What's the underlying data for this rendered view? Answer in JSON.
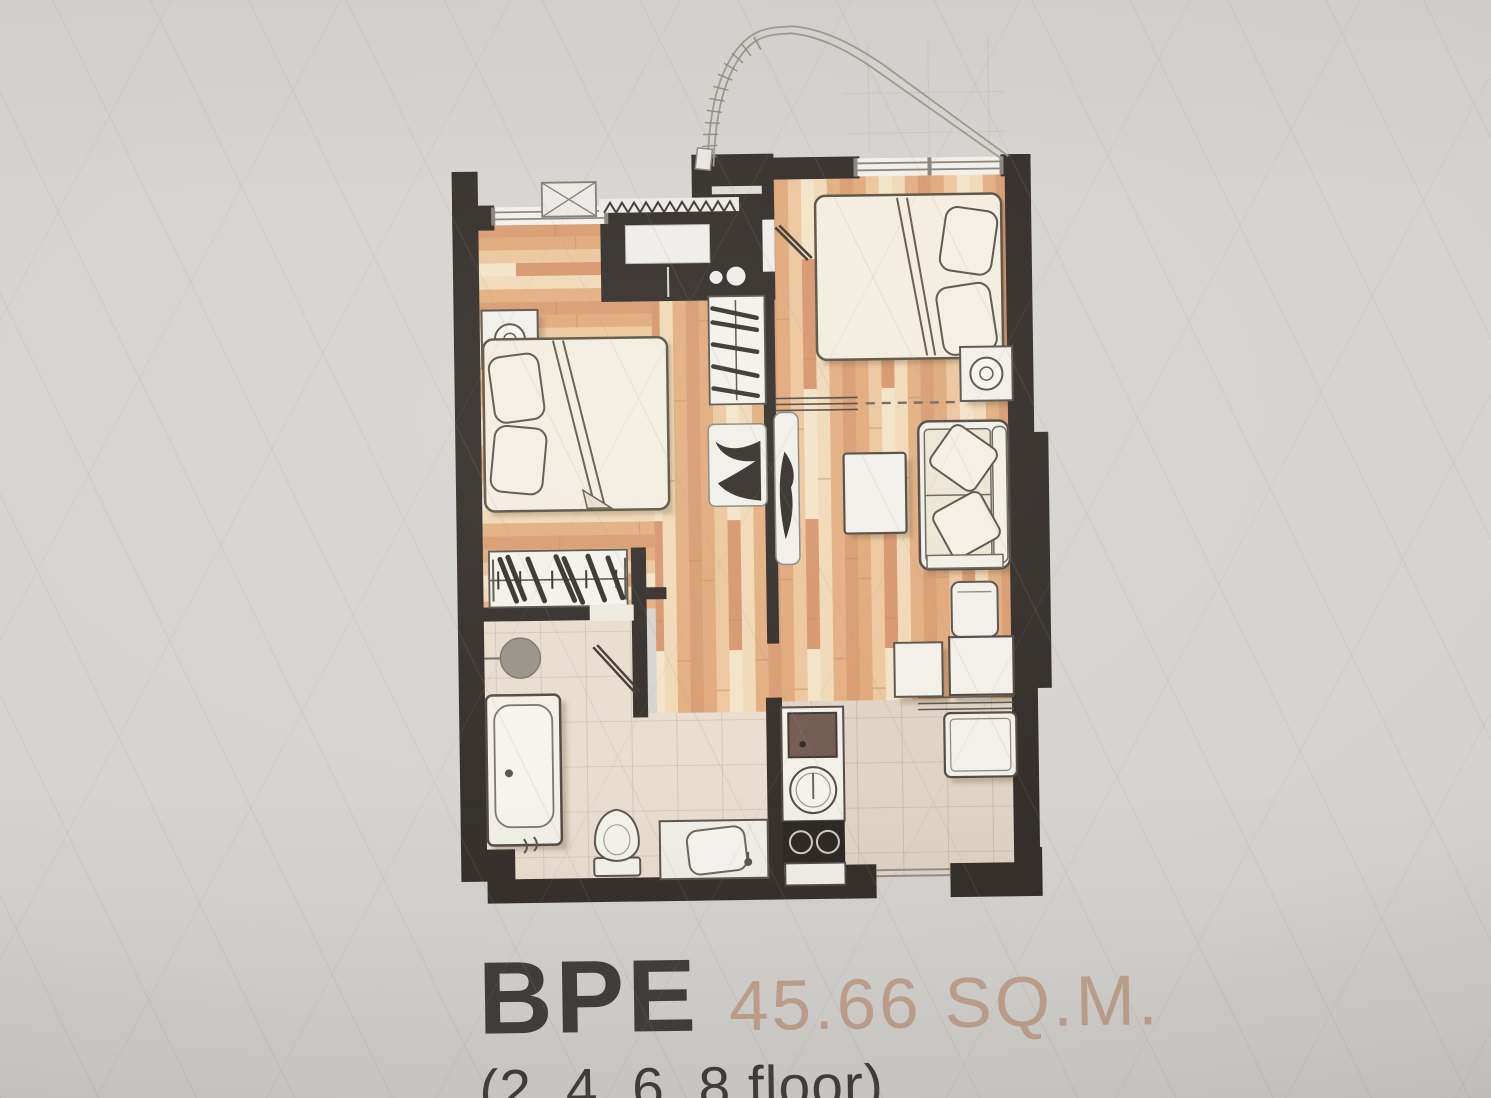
{
  "caption": {
    "unit_name": "BPE",
    "area": "45.66 SQ.M.",
    "floors": "(2, 4, 6, 8 floor)"
  },
  "palette": {
    "photo_background": "#d5d3d0",
    "wall": "#2f2a26",
    "wood_mid": "#e0aa7c",
    "wood_pale": "#f0d8b4",
    "bath_tile": "#e8dccd",
    "kitchen_tile": "#e0d2c3",
    "furniture_fill": "#f1efe8",
    "furniture_outline": "#55504a",
    "linen": "#f2edde",
    "unit_name_color": "#3b3836",
    "area_color": "#c1a18c",
    "floors_color": "#383533"
  },
  "floor_plan": {
    "rooms": [
      {
        "name": "bedroom-left",
        "elements": [
          "double-bed",
          "pillows",
          "nightstand-with-lamp",
          "wardrobe-with-hangers",
          "window",
          "air-conditioner-unit"
        ]
      },
      {
        "name": "hall",
        "elements": [
          "closet-with-hangers",
          "door-swing-left",
          "door-swing-right",
          "wall-shelf",
          "dashed-partition"
        ]
      },
      {
        "name": "master-bedroom",
        "elements": [
          "double-bed",
          "pillows",
          "nightstand-with-lamp",
          "window",
          "entrance-door-leaf"
        ]
      },
      {
        "name": "living-area",
        "elements": [
          "sofa-with-cushions",
          "coffee-table"
        ]
      },
      {
        "name": "dining-area",
        "elements": [
          "dining-table",
          "side-table",
          "chair",
          "refrigerator"
        ]
      },
      {
        "name": "kitchen",
        "elements": [
          "counter",
          "round-sink",
          "two-burner-stove",
          "base-cabinet"
        ]
      },
      {
        "name": "bathroom",
        "elements": [
          "bathtub",
          "toilet",
          "vanity-sink",
          "shower-head",
          "door-swing"
        ]
      }
    ],
    "annotations": [
      "exhaust-duct-curve",
      "entrance-shaft-block",
      "sketch-guidelines"
    ]
  }
}
